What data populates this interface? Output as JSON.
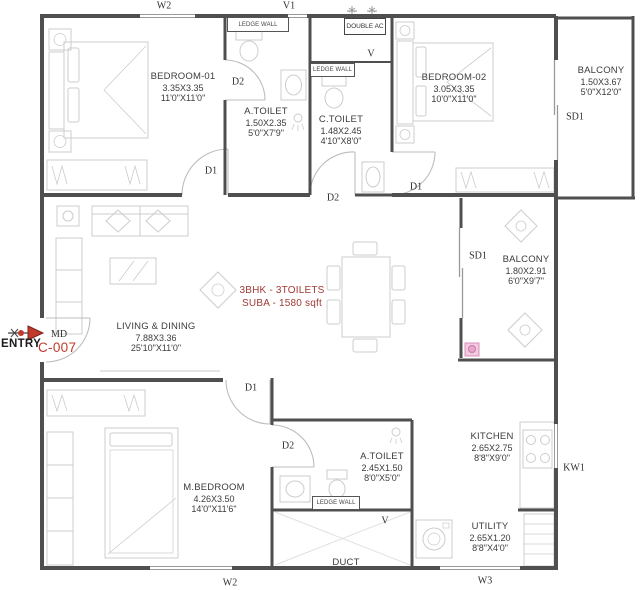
{
  "colors": {
    "wall": "#4f4f4f",
    "furniture": "#c9c9c9",
    "text": "#3c3c3c",
    "accent_red": "#c0392b",
    "note_red": "#a03a36",
    "pink": "#e9aed0"
  },
  "title_block": {
    "entry": "ENTRY",
    "main_door": "MD",
    "unit": "C-007",
    "type_line": "3BHK - 3TOILETS",
    "area_line": "SUBA - 1580 sqft"
  },
  "rooms": {
    "bedroom1": {
      "name": "BEDROOM-01",
      "dim_m": "3.35X3.35",
      "dim_ft": "11'0\"X11'0\""
    },
    "atoilet1": {
      "name": "A.TOILET",
      "dim_m": "1.50X2.35",
      "dim_ft": "5'0\"X7'9\""
    },
    "ctoilet": {
      "name": "C.TOILET",
      "dim_m": "1.48X2.45",
      "dim_ft": "4'10\"X8'0\""
    },
    "bedroom2": {
      "name": "BEDROOM-02",
      "dim_m": "3.05X3.35",
      "dim_ft": "10'0\"X11'0\""
    },
    "balcony1": {
      "name": "BALCONY",
      "dim_m": "1.50X3.67",
      "dim_ft": "5'0\"X12'0\""
    },
    "living": {
      "name": "LIVING & DINING",
      "dim_m": "7.88X3.36",
      "dim_ft": "25'10\"X11'0\""
    },
    "balcony2": {
      "name": "BALCONY",
      "dim_m": "1.80X2.91",
      "dim_ft": "6'0\"X9'7\""
    },
    "mbedroom": {
      "name": "M.BEDROOM",
      "dim_m": "4.26X3.50",
      "dim_ft": "14'0\"X11'6\""
    },
    "atoilet2": {
      "name": "A.TOILET",
      "dim_m": "2.45X1.50",
      "dim_ft": "8'0\"X5'0\""
    },
    "kitchen": {
      "name": "KITCHEN",
      "dim_m": "2.65X2.75",
      "dim_ft": "8'8\"X9'0\""
    },
    "utility": {
      "name": "UTILITY",
      "dim_m": "2.65X1.20",
      "dim_ft": "8'8\"X4'0\""
    },
    "duct": {
      "name": "DUCT"
    }
  },
  "markers": {
    "w2_top": "W2",
    "v1": "V1",
    "v_top": "V",
    "ledge1": "LEDGE WALL",
    "double_ac": "DOUBLE AC",
    "ledge2": "LEDGE WALL",
    "d2_bedroom1_toilet": "D2",
    "d1_bedroom1": "D1",
    "d2_ctoilet": "D2",
    "d1_bedroom2": "D1",
    "sd1_balcony1": "SD1",
    "sd1_balcony2": "SD1",
    "d1_mbedroom": "D1",
    "d2_mtoilet": "D2",
    "ledge3": "LEDGE WALL",
    "v_bottom": "V",
    "kw1": "KW1",
    "w3": "W3",
    "w2_bottom": "W2"
  }
}
